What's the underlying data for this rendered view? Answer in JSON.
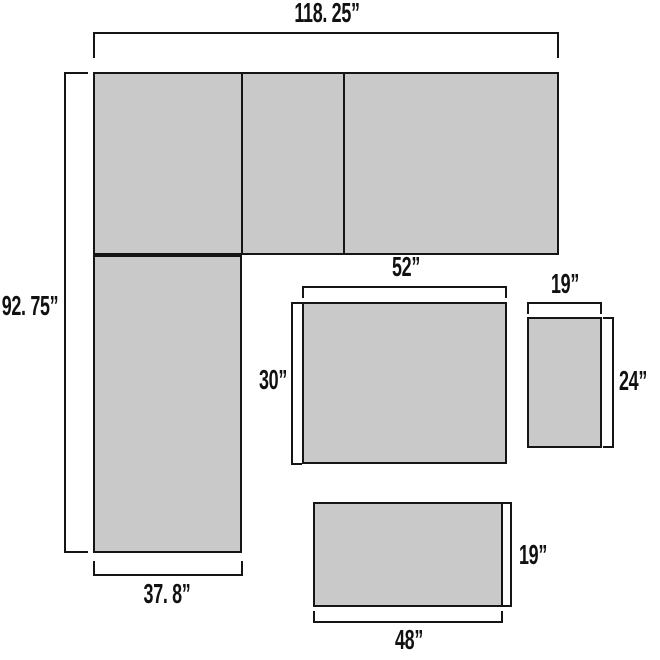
{
  "diagram": {
    "type": "furniture-dimension-diagram",
    "background_color": "#ffffff",
    "shape_fill_color": "#c9c9c9",
    "line_color": "#151515",
    "unit": "inches",
    "sectional": {
      "total_width_label": "118. 25”",
      "total_depth_label": "92. 75”",
      "chaise_width_label": "37. 8”"
    },
    "coffee_table": {
      "width_label": "52”",
      "depth_label": "30”"
    },
    "side_table": {
      "width_label": "19”",
      "depth_label": "24”"
    },
    "bench": {
      "width_label": "48”",
      "depth_label": "19”"
    }
  }
}
